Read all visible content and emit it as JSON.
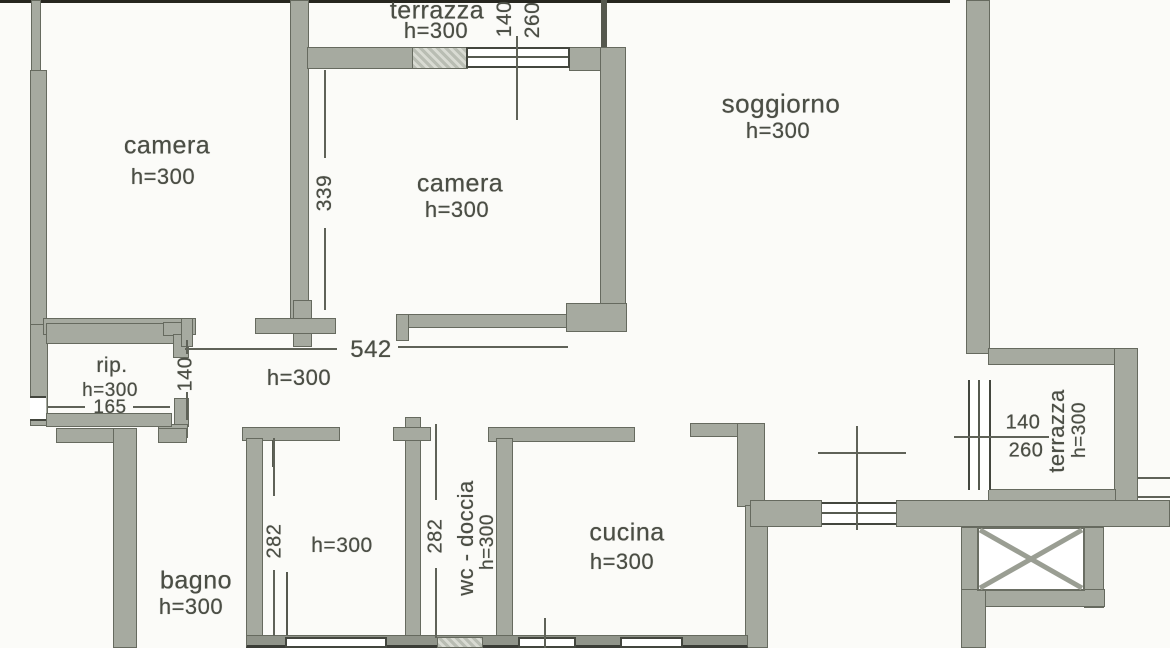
{
  "colors": {
    "background": "#fbfbf8",
    "wall": "#a6aaa0",
    "wall_dark": "#90948a",
    "outline": "#666a5f",
    "text": "#4b4e45",
    "dim_line": "#5f6258",
    "window_border": "#43463e"
  },
  "rooms": {
    "terrazza_top": {
      "name": "terrazza",
      "height": "h=300"
    },
    "camera_left": {
      "name": "camera",
      "height": "h=300"
    },
    "camera_mid": {
      "name": "camera",
      "height": "h=300"
    },
    "soggiorno": {
      "name": "soggiorno",
      "height": "h=300"
    },
    "rip": {
      "name": "rip.",
      "height": "h=300",
      "width": "165"
    },
    "corridoio": {
      "height": "h=300",
      "length": "542",
      "width": "140"
    },
    "bagno": {
      "name": "bagno",
      "height": "h=300"
    },
    "cameretta": {
      "height": "h=300",
      "depth": "282"
    },
    "wc_doccia": {
      "name": "wc - doccia",
      "height": "h=300",
      "depth": "282"
    },
    "cucina": {
      "name": "cucina",
      "height": "h=300"
    },
    "terrazza_right": {
      "name": "terrazza",
      "height": "h=300"
    }
  },
  "windows": {
    "top": {
      "w": "140",
      "h": "260"
    },
    "right": {
      "w": "140",
      "h": "260"
    }
  },
  "dims": {
    "camera_mid_wall": "339"
  }
}
